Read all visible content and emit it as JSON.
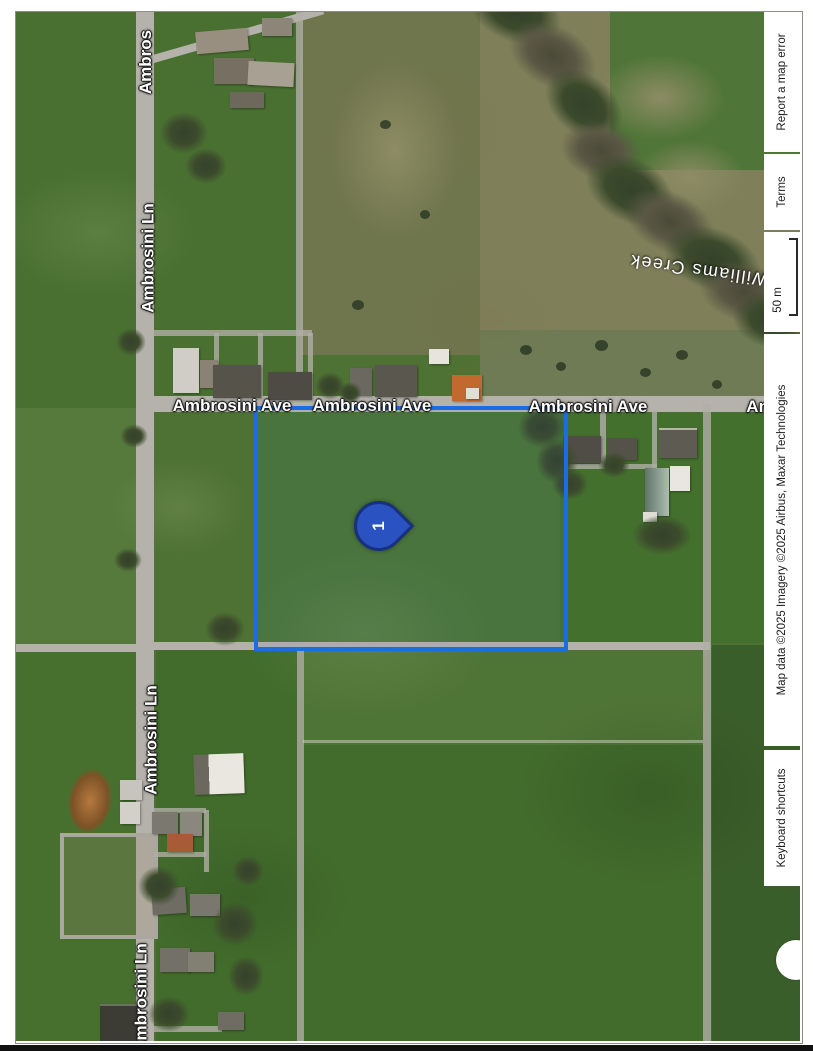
{
  "map": {
    "labels": {
      "ambros_top": "Ambros",
      "ln_upper": "Ambrosini Ln",
      "ln_middle": "Ambrosini Ln",
      "ln_bottom": "Ambrosini Ln",
      "ave_1": "Ambrosini Ave",
      "ave_2": "Ambrosini Ave",
      "ave_3": "Ambrosini Ave",
      "ave_partial": "Am",
      "creek": "Williams Creek"
    },
    "marker": {
      "label": "1"
    },
    "parcel_outline_color": "#1e6ce2",
    "marker_color": "#2a52c0",
    "attribution": {
      "keyboard_shortcuts": "Keyboard shortcuts",
      "map_data": "Map data ©2025 Imagery ©2025 Airbus, Maxar Technologies",
      "scale": "50 m",
      "terms": "Terms",
      "report_error": "Report a map error"
    }
  }
}
